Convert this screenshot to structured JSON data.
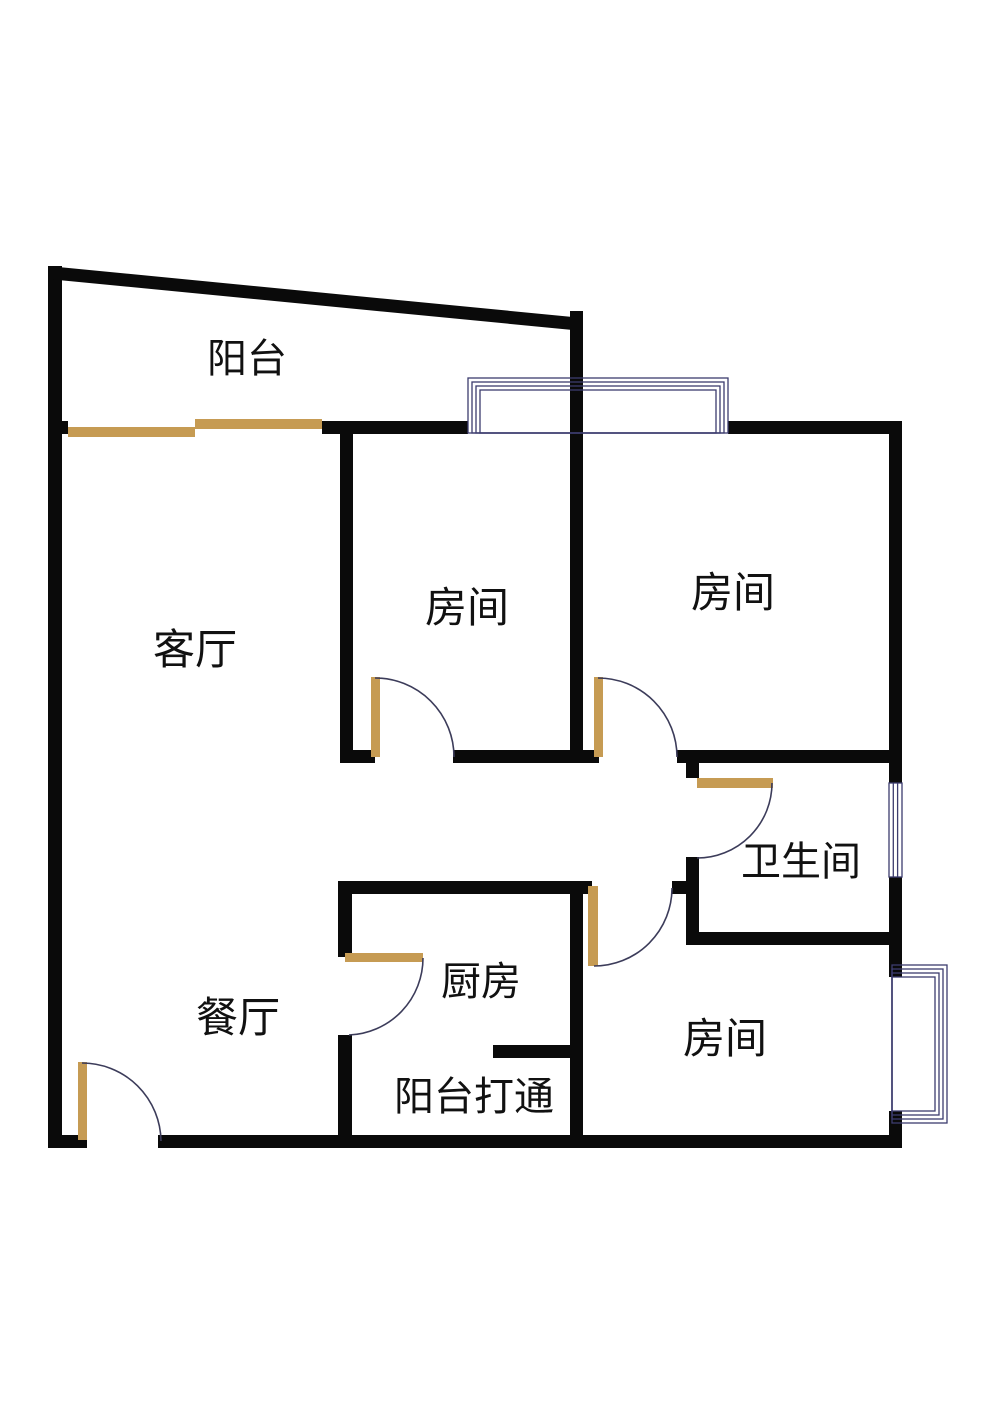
{
  "page": {
    "type": "apartment-floor-plan"
  },
  "colors": {
    "background": "#ffffff",
    "wall": "#0a0a0a",
    "door": "#c69b53",
    "arc": "#3c3c5a",
    "window": "#3c3c6e",
    "text": "#111111"
  },
  "rooms": [
    {
      "id": "balcony-top",
      "label": "阳台"
    },
    {
      "id": "living-room",
      "label": "客厅"
    },
    {
      "id": "bedroom-top-middle",
      "label": "房间"
    },
    {
      "id": "bedroom-top-right",
      "label": "房间"
    },
    {
      "id": "bathroom",
      "label": "卫生间"
    },
    {
      "id": "dining-room",
      "label": "餐厅"
    },
    {
      "id": "kitchen",
      "label": "厨房"
    },
    {
      "id": "balcony-opened",
      "label": "阳台打通"
    },
    {
      "id": "bedroom-bottom-right",
      "label": "房间"
    }
  ]
}
